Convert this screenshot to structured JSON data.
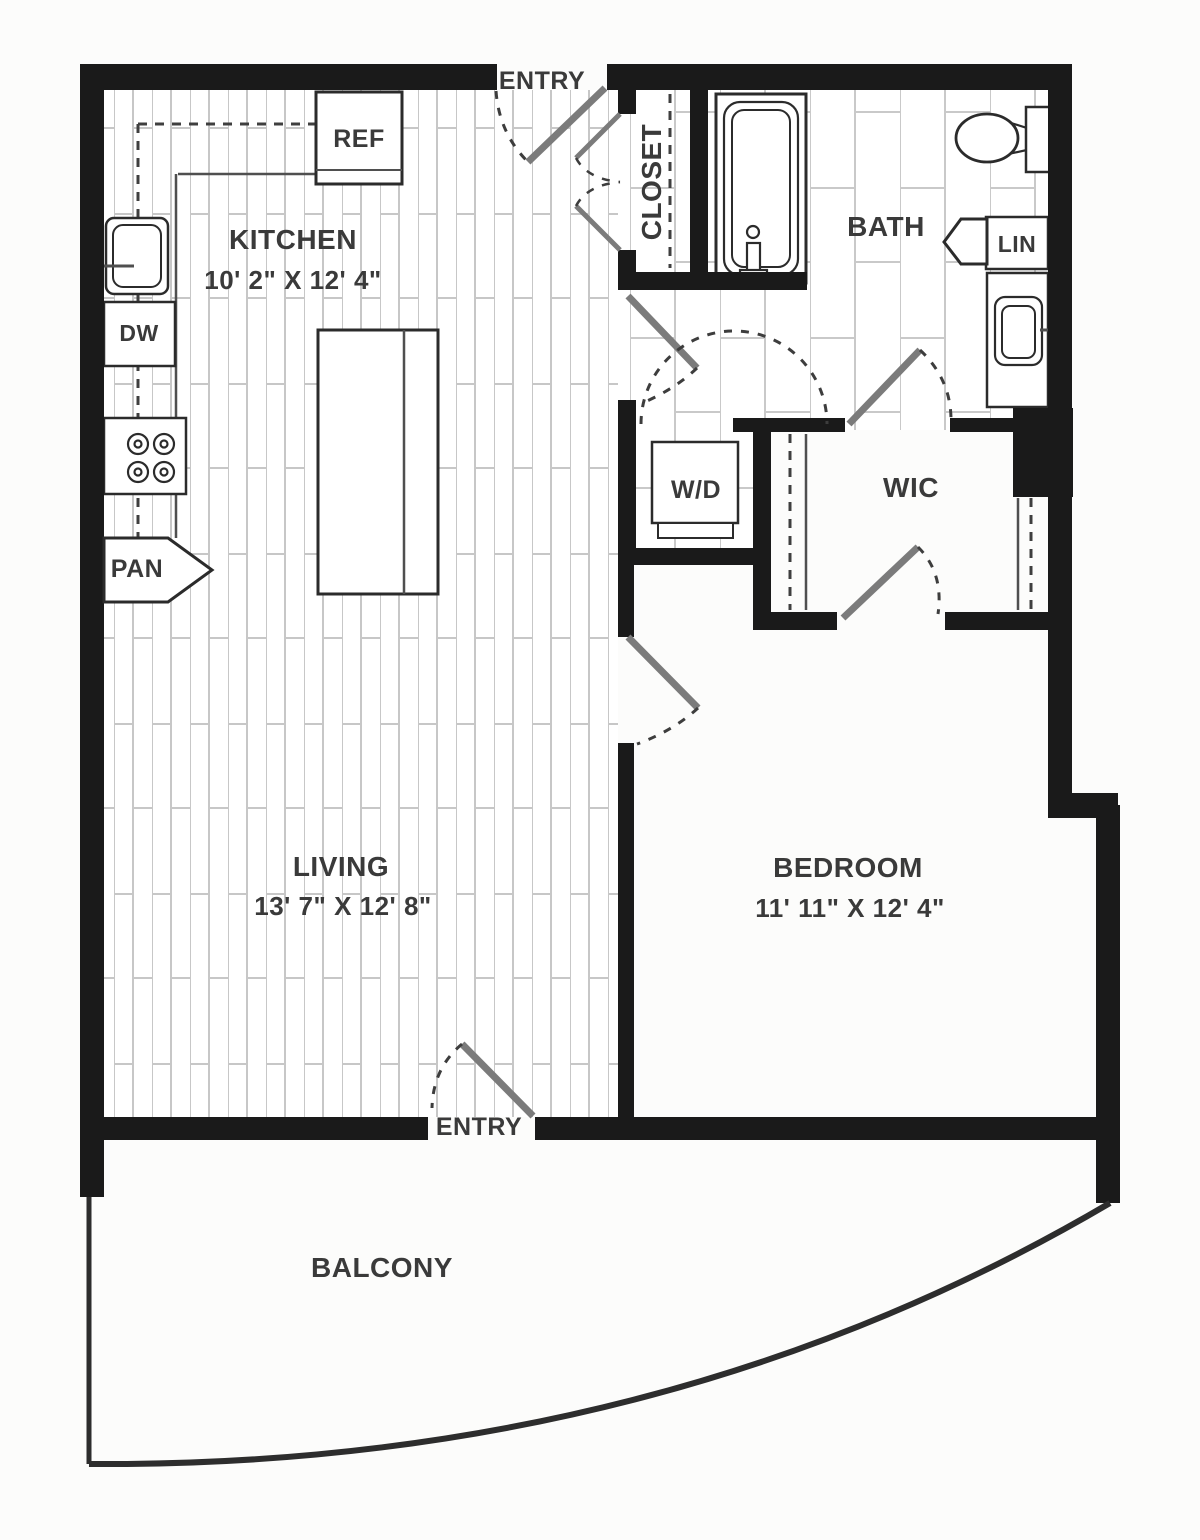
{
  "plan": {
    "type": "apartment-floor-plan",
    "colors": {
      "wall": "#1a1a1a",
      "text": "#3a3a3a",
      "door_leaf": "#7b7b7b",
      "paper": "#fcfcfb"
    },
    "rooms": {
      "kitchen": {
        "label": "KITCHEN",
        "dims": "10' 2\" X 12' 4\""
      },
      "living": {
        "label": "LIVING",
        "dims": "13' 7\" X 12' 8\""
      },
      "bedroom": {
        "label": "BEDROOM",
        "dims": "11' 11\" X 12' 4\""
      },
      "bath": {
        "label": "BATH"
      },
      "closet": {
        "label": "CLOSET"
      },
      "wic": {
        "label": "WIC"
      },
      "balcony": {
        "label": "BALCONY"
      }
    },
    "fixtures": {
      "refrigerator": {
        "label": "REF"
      },
      "dishwasher": {
        "label": "DW"
      },
      "pantry": {
        "label": "PAN"
      },
      "washer_dryer": {
        "label": "W/D"
      },
      "linen": {
        "label": "LIN"
      }
    },
    "entries": {
      "top": "ENTRY",
      "bottom": "ENTRY"
    }
  }
}
